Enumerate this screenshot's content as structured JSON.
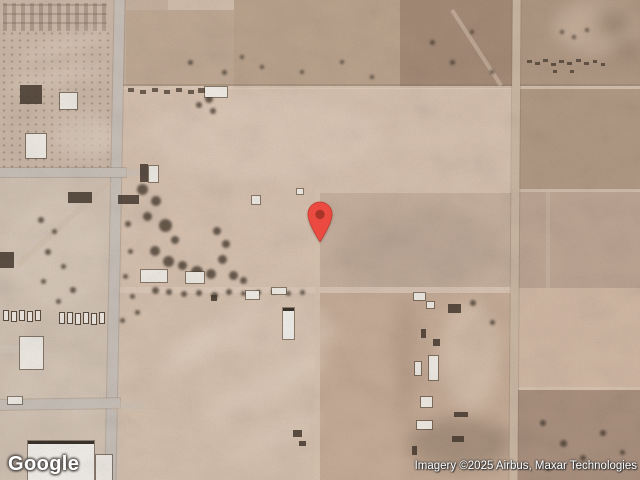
{
  "map": {
    "view_type": "satellite",
    "logo_text": "Google",
    "attribution": "Imagery ©2025 Airbus, Maxar Technologies",
    "marker": {
      "name": "location-pin",
      "color": "#EA4A40",
      "stroke_color": "#C43B31",
      "inner_color": "#A83429"
    },
    "palette": {
      "terrain_light": "#d9c3b1",
      "terrain_pink": "#d3baa6",
      "terrain_scrub_dark": "#a78d79",
      "paved_road": "#cac2ba",
      "dirt_road": "#cdb9a5",
      "building_white": "#f1ede6",
      "building_dark": "#463a2f"
    }
  }
}
